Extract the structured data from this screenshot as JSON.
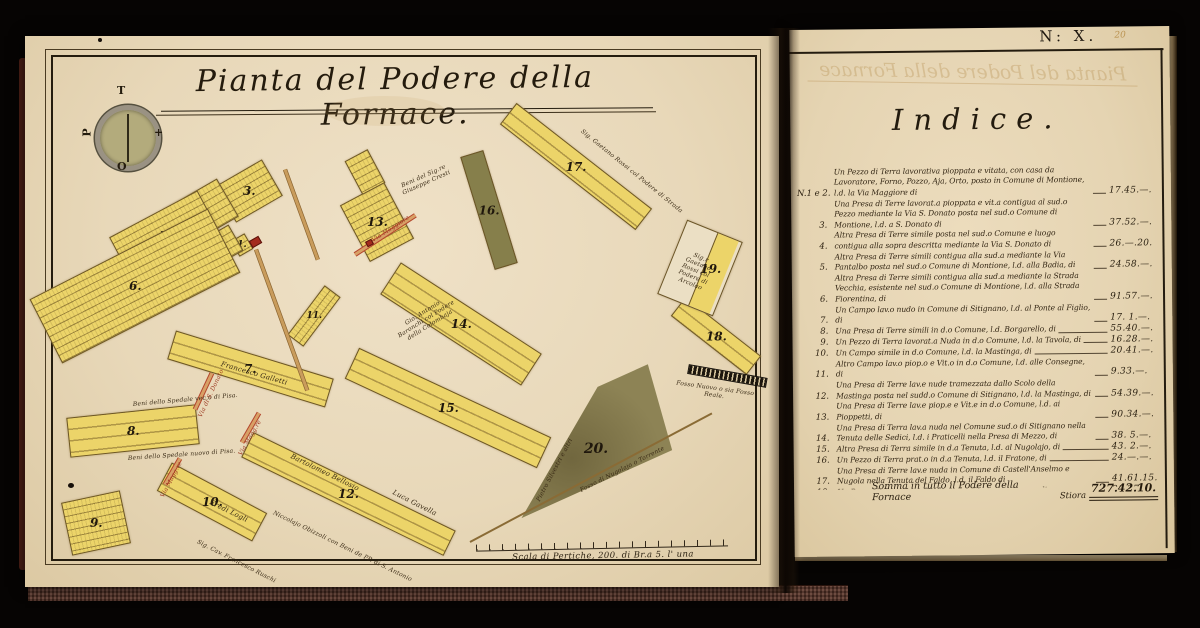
{
  "map": {
    "title": "Pianta del Podere della Fornace.",
    "compass": {
      "north": "T",
      "south": "O",
      "west": "P",
      "east": "+"
    },
    "scale_label": "Scala di Pertiche, 200. di Br.a 5. l' una",
    "parcels": [
      "1.",
      "2.",
      "3.",
      "4.",
      "5.",
      "6.",
      "7.",
      "8.",
      "9.",
      "10.",
      "11.",
      "12.",
      "13.",
      "14.",
      "15.",
      "16.",
      "17.",
      "18.",
      "19.",
      "20."
    ],
    "labels": {
      "cresti": "Beni del Sig.re Giuseppe Cresti",
      "via_maggiore_13": "Via Maggiore",
      "spedale_vecchio": "Beni dello Spedale vec.o di Pisa.",
      "spedale_nuovo": "Beni dello Spedale nuovo di Pisa.",
      "galletti": "Francesco Galletti",
      "eredi_logli": "Eredi Logli",
      "ruschi": "Sig. Cav. Francesco Ruschi",
      "bellosio": "Bartolomeo Bellosio",
      "gavella": "Luca Gavella",
      "obizzoli": "Niccolajo Obizzoli con Beni de PP. di S. Antonio",
      "baronchi": "Gio. Antonio Baronchi col Podere della Colombaja",
      "rossi_strada": "Sig. Gaetano Rossi col Podere di Strada",
      "rossi_arcolao": "Sig.r Gaetano Rossi col Podere di Arcolao",
      "silvestri": "Pietro Silvestri e altri",
      "fosso_nugolajo": "Fosso di Nugolajo o Torrente",
      "fosso_reale": "Fosso Nuovo o sia Fosso Reale.",
      "via_magg_10": "Via Magg.re",
      "via_magg_12": "Via Magg.re",
      "via_s_donato": "Via di S. Donato"
    }
  },
  "index": {
    "page_mark": "N: X.",
    "folio": "20",
    "bleedthrough": "Pianta del Podere della Fornace",
    "heading": "Indice.",
    "entries": [
      {
        "num": "N.1 e 2.",
        "text": "Un Pezzo di Terra lavorativa pioppata e vitata, con casa da Lavoratore, Forno, Pozzo, Aja, Orto, posto in Comune di Montione, l.d. la Via Maggiore di",
        "value": "17.45.—."
      },
      {
        "num": "3.",
        "text": "Una Presa di Terre lavorat.a pioppata e vit.a contigua al sud.o Pezzo mediante la Via S. Donato posta nel sud.o Comune di Montione, l.d. a S. Donato di",
        "value": "37.52.—."
      },
      {
        "num": "4.",
        "text": "Altra Presa di Terre simile posta nel sud.o Comune e luogo contigua alla sopra descritta mediante la Via S. Donato di",
        "value": "26.—.20."
      },
      {
        "num": "5.",
        "text": "Altra Presa di Terre simili contigua alla sud.a mediante la Via Pantalbo posta nel sud.o Comune di Montione, l.d. alla Badia, di",
        "value": "24.58.—."
      },
      {
        "num": "6.",
        "text": "Altra Presa di Terre simili contigua alla sud.a mediante la Strada Vecchia, esistente nel sud.o Comune di Montione, l.d. alla Strada Fiorentina, di",
        "value": "91.57.—."
      },
      {
        "num": "7.",
        "text": "Un Campo lav.o nudo in Comune di Sitignano, l.d. al Ponte al Figlio, di",
        "value": "17. 1.—."
      },
      {
        "num": "8.",
        "text": "Una Presa di Terre simili in d.o Comune, l.d. Borgarello, di",
        "value": "55.40.—."
      },
      {
        "num": "9.",
        "text": "Un Pezzo di Terra lavorat.a Nuda in d.o Comune, l.d. la Tavola, di",
        "value": "16.28.—."
      },
      {
        "num": "10.",
        "text": "Un Campo simile in d.o Comune, l.d. la Mastinga, di",
        "value": "20.41.—."
      },
      {
        "num": "11.",
        "text": "Altro Campo lav.o piop.o e Vit.o in d.o Comune, l.d. alle Consegne, di",
        "value": "9.33.—."
      },
      {
        "num": "12.",
        "text": "Una Presa di Terre lav.e nude tramezzata dallo Scolo della Mastinga posta nel sudd.o Comune di Sitignano, l.d. la Mastinga, di",
        "value": "54.39.—."
      },
      {
        "num": "13.",
        "text": "Una Presa di Terre lav.e piop.e e Vit.e in d.o Comune, l.d. ai Pioppetti, di",
        "value": "90.34.—."
      },
      {
        "num": "14.",
        "text": "Una Presa di Terra lav.a nuda nel Comune sud.o di Sitignano nella Tenuta delle Sedici, l.d. i Praticelli nella Presa di Mezzo, di",
        "value": "38. 5.—."
      },
      {
        "num": "15.",
        "text": "Altra Presa di Terra simile in d.a Tenuta, l.d. al Nugolajo, di",
        "value": "43. 2.—."
      },
      {
        "num": "16.",
        "text": "Un Pezzo di Terra prat.o in d.a Tenuta, l.d. il Fratone, di",
        "value": "24.—.—."
      },
      {
        "num": "17.",
        "text": "Una Presa di Terre lav.e nuda in Comune di Castell'Anselmo e Nugola nella Tenuta del Faldo, l.d. il Faldo di",
        "value": "41.61.15."
      },
      {
        "num": "18.",
        "text": "Un Pezzo di Terra lav.a Nuda in d.o Comune e Luogo, di",
        "value": "20.27.—."
      },
      {
        "num": "19.",
        "text": "Altro Pezzo di Terra simile in d.o Comune e luogo, di",
        "value": "16.—.—."
      },
      {
        "num": "20.",
        "text": "Una Presa di Terra prativa in Comune di Sitignano nella Tenuta delle Sedici, l.d. la Pastura nella Tavolata di Nugolajo, di",
        "value": "146.58.—."
      }
    ],
    "total_label": "Somma in tutto il Podere della Fornace",
    "total_unit": "Stiora",
    "total_value": "727.42.10."
  }
}
